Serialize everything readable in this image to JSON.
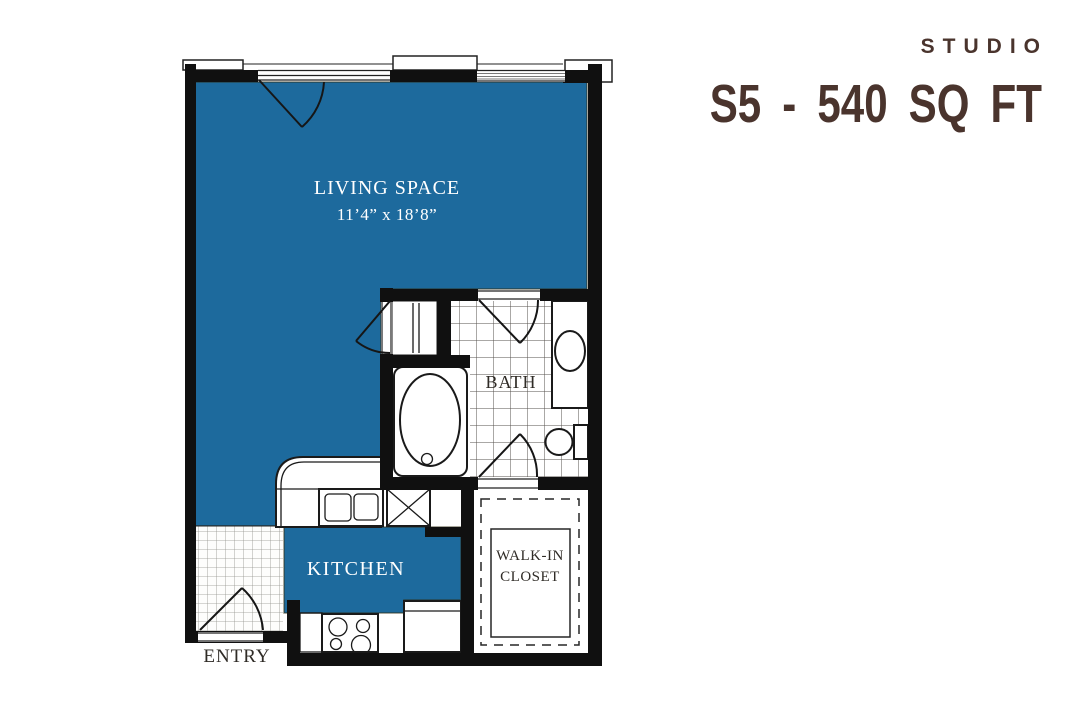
{
  "header": {
    "category": "STUDIO",
    "plan": "S5 - 540 SQ FT"
  },
  "rooms": {
    "living": {
      "label": "LIVING SPACE",
      "dimensions": "11’4” x 18’8”"
    },
    "bath": {
      "label": "BATH"
    },
    "kitchen": {
      "label": "KITCHEN"
    },
    "closet": {
      "line1": "WALK-IN",
      "line2": "CLOSET"
    },
    "entry": {
      "label": "ENTRY"
    }
  },
  "colors": {
    "room-fill": "#1d6a9d",
    "wall": "#101010",
    "accent-text": "#4a342d",
    "label-dark": "#2f2b26"
  }
}
